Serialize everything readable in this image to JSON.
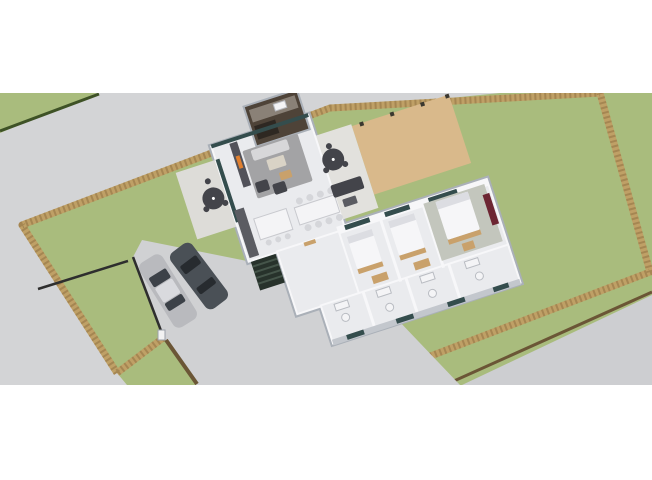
{
  "scene": {
    "title": "3D isometric architectural rendering",
    "description": "Aerial cutaway view of a modern single-story house centered on a large walled plot with lawn, driveway, two parked cars, perimeter stone walls and surrounding roads. No visible text in the image.",
    "view": "isometric aerial floor-plan render"
  },
  "colors": {
    "page_background": "#ffffff",
    "grass": "#a9bc7d",
    "road": "#d3d4d6",
    "road2": "#cdced1",
    "driveway": "#d0d1d3",
    "hedge": "#3e5226",
    "wall_stone": "#bfa066",
    "wall_stone_dark": "#8f7142",
    "road_edge": "#6b5636",
    "fence": "#2e2e2e",
    "house_wall": "#f7f7f9",
    "house_wall_shadow": "#aab0b8",
    "house_floor": "#eaebee",
    "exterior_wall": "#c3c7cd",
    "glass": "#344d4d",
    "terrace": "#dddcd8",
    "patio": "#e2e1dd",
    "deck": "#d9b98b",
    "post": "#3b382f",
    "outdoor_kitchen": "#4e4338",
    "okitchen_counter": "#8a8177",
    "okitchen_dark": "#2e2822",
    "accent_wall": "#52525a",
    "fireplace": "#e07f2f",
    "rug": "#a3a3a5",
    "sofa_light": "#d7d7d9",
    "sofa_dark": "#43444a",
    "wood_tan": "#c9a16b",
    "wood_light": "#d9d3c6",
    "table_white": "#f4f4f6",
    "chair": "#d5d6da",
    "counter": "#5b5c62",
    "bed": "#f6f6f8",
    "pillow": "#dcdde2",
    "master_carpet": "#c3c6bd",
    "wardrobe_red": "#6d2633",
    "fixture": "#f4f4f6",
    "steps": "#27322b",
    "steps_light": "#45554a",
    "car_silver": "#b9babe",
    "car_silver_roof": "#d9dade",
    "car_silver_glass": "#3c4148",
    "car_dark": "#4a5056",
    "car_dark_glass": "#272b2f",
    "gate_post": "#f2f2f2"
  },
  "site": {
    "boundary": "stone perimeter wall on all sides",
    "areas": [
      "road upper-left",
      "road lower-right",
      "lawn inside walls",
      "front lawn parcel",
      "concrete driveway",
      "front fence with gate post"
    ],
    "vehicles": [
      {
        "name": "silver sedan",
        "color": "#b9babe"
      },
      {
        "name": "dark gray sedan",
        "color": "#4a5056"
      }
    ]
  },
  "house": {
    "wings": [
      "open-plan living wing",
      "entry foyer",
      "bedroom wing",
      "bathroom strip"
    ],
    "rooms": [
      {
        "name": "living room",
        "furniture": [
          "fireplace accent wall",
          "rug",
          "sofa",
          "two armchairs",
          "coffee table",
          "pouf"
        ]
      },
      {
        "name": "kitchen",
        "furniture": [
          "wall counter",
          "island with three stools"
        ]
      },
      {
        "name": "dining area",
        "furniture": [
          "table",
          "eight chairs"
        ]
      },
      {
        "name": "bedroom 1",
        "furniture": [
          "double bed",
          "foot bench",
          "closet"
        ]
      },
      {
        "name": "bedroom 2",
        "furniture": [
          "double bed",
          "foot bench",
          "closet"
        ]
      },
      {
        "name": "master bedroom",
        "furniture": [
          "double bed",
          "carpet",
          "red wardrobe",
          "side table"
        ]
      },
      {
        "name": "bathrooms",
        "furniture": [
          "toilets",
          "sinks"
        ]
      }
    ],
    "outdoor": [
      "left terrace with parasol",
      "covered patio with parasol and lounge sofa",
      "timber deck with posts",
      "outdoor kitchen block",
      "entry steps"
    ]
  }
}
